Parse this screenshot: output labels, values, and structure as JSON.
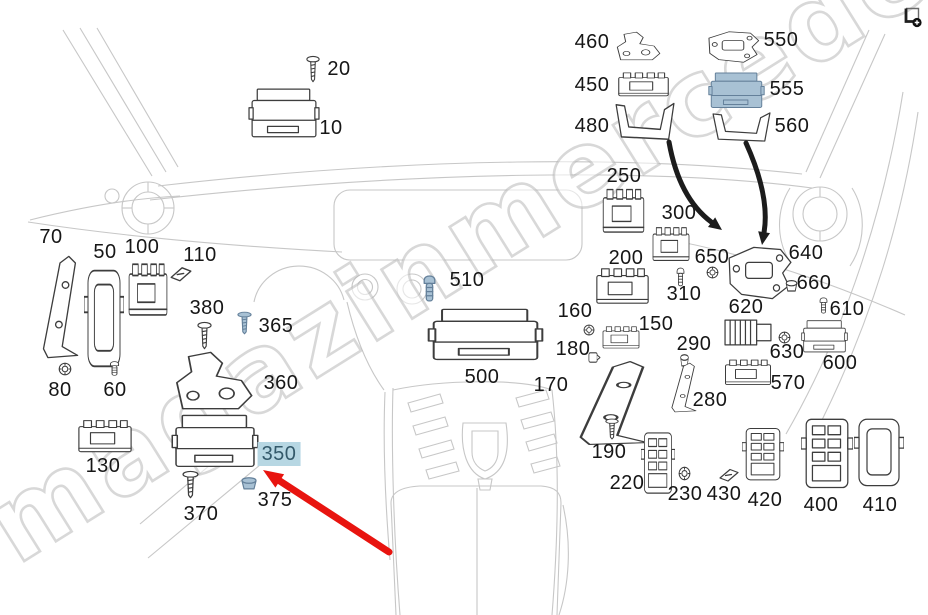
{
  "watermark": {
    "text": "magazinmercedes.ru"
  },
  "icons": {
    "top_right": "enlarge-image-icon"
  },
  "colors": {
    "highlight_bg": "#b7d7e3",
    "highlight_text": "#33596a",
    "red_arrow": "#e8140f",
    "black_arrow": "#1c1c1c",
    "blue_part_fill": "#a8c1d4",
    "line_art": "#3d3d3d",
    "sketch": "#c7c7c7"
  },
  "annotations": {
    "highlighted_part": "350",
    "red_arrow": {
      "from": [
        389,
        552
      ],
      "to": [
        263,
        470
      ]
    },
    "black_arrows": [
      {
        "from": [
          669,
          142
        ],
        "ctrl": [
          679,
          198
        ],
        "to": [
          722,
          230
        ]
      },
      {
        "from": [
          746,
          143
        ],
        "ctrl": [
          770,
          196
        ],
        "to": [
          762,
          245
        ]
      }
    ]
  },
  "diagram": {
    "parts": [
      {
        "label": "10",
        "kind": "ecu",
        "x": 248,
        "y": 85,
        "w": 72,
        "h": 58,
        "lx": 331,
        "ly": 128
      },
      {
        "label": "20",
        "kind": "screw",
        "x": 306,
        "y": 55,
        "w": 14,
        "h": 28,
        "lx": 339,
        "ly": 69
      },
      {
        "label": "460",
        "kind": "bracket",
        "x": 614,
        "y": 30,
        "w": 50,
        "h": 32,
        "lx": 592,
        "ly": 42
      },
      {
        "label": "550",
        "kind": "platebracket",
        "x": 704,
        "y": 28,
        "w": 58,
        "h": 38,
        "lx": 781,
        "ly": 40
      },
      {
        "label": "450",
        "kind": "module",
        "x": 616,
        "y": 71,
        "w": 55,
        "h": 28,
        "lx": 592,
        "ly": 85
      },
      {
        "label": "555",
        "kind": "ecu",
        "blue": true,
        "x": 708,
        "y": 70,
        "w": 57,
        "h": 42,
        "lx": 787,
        "ly": 89
      },
      {
        "label": "480",
        "kind": "ubracket",
        "x": 613,
        "y": 101,
        "w": 63,
        "h": 42,
        "lx": 592,
        "ly": 126
      },
      {
        "label": "560",
        "kind": "ubracket",
        "x": 710,
        "y": 111,
        "w": 62,
        "h": 33,
        "lx": 792,
        "ly": 126
      },
      {
        "label": "250",
        "kind": "module",
        "x": 601,
        "y": 186,
        "w": 45,
        "h": 52,
        "lx": 624,
        "ly": 176
      },
      {
        "label": "300",
        "kind": "module",
        "x": 651,
        "y": 225,
        "w": 40,
        "h": 40,
        "lx": 679,
        "ly": 213
      },
      {
        "label": "70",
        "kind": "brackettall",
        "x": 38,
        "y": 252,
        "w": 44,
        "h": 110,
        "lx": 51,
        "ly": 237
      },
      {
        "label": "50",
        "kind": "cover",
        "x": 84,
        "y": 266,
        "w": 40,
        "h": 108,
        "lx": 105,
        "ly": 252
      },
      {
        "label": "100",
        "kind": "module",
        "x": 127,
        "y": 260,
        "w": 42,
        "h": 62,
        "lx": 142,
        "ly": 247
      },
      {
        "label": "110",
        "kind": "fuse",
        "x": 169,
        "y": 265,
        "w": 24,
        "h": 18,
        "lx": 200,
        "ly": 255
      },
      {
        "label": "80",
        "kind": "nut",
        "x": 58,
        "y": 362,
        "w": 14,
        "h": 14,
        "lx": 60,
        "ly": 390
      },
      {
        "label": "60",
        "kind": "bolt",
        "x": 108,
        "y": 360,
        "w": 13,
        "h": 17,
        "lx": 115,
        "ly": 390
      },
      {
        "label": "650",
        "kind": "nut",
        "x": 706,
        "y": 266,
        "w": 13,
        "h": 13,
        "lx": 712,
        "ly": 257
      },
      {
        "label": "640",
        "kind": "platebracket",
        "x": 723,
        "y": 241,
        "w": 72,
        "h": 64,
        "lx": 806,
        "ly": 253
      },
      {
        "label": "200",
        "kind": "module",
        "x": 594,
        "y": 266,
        "w": 57,
        "h": 42,
        "lx": 626,
        "ly": 258
      },
      {
        "label": "660",
        "kind": "grommet",
        "x": 784,
        "y": 279,
        "w": 15,
        "h": 14,
        "lx": 814,
        "ly": 283
      },
      {
        "label": "310",
        "kind": "bolt",
        "x": 675,
        "y": 266,
        "w": 11,
        "h": 22,
        "lx": 684,
        "ly": 294
      },
      {
        "label": "510",
        "kind": "bolt",
        "blue": true,
        "x": 421,
        "y": 273,
        "w": 17,
        "h": 31,
        "lx": 467,
        "ly": 280
      },
      {
        "label": "380",
        "kind": "screw",
        "x": 197,
        "y": 321,
        "w": 15,
        "h": 29,
        "lx": 207,
        "ly": 308
      },
      {
        "label": "365",
        "kind": "screw",
        "blue": true,
        "x": 237,
        "y": 311,
        "w": 15,
        "h": 24,
        "lx": 276,
        "ly": 326
      },
      {
        "label": "160",
        "kind": "nut",
        "x": 583,
        "y": 324,
        "w": 12,
        "h": 12,
        "lx": 575,
        "ly": 311
      },
      {
        "label": "150",
        "kind": "module",
        "x": 601,
        "y": 325,
        "w": 40,
        "h": 26,
        "lx": 656,
        "ly": 324
      },
      {
        "label": "610",
        "kind": "bolt",
        "x": 818,
        "y": 296,
        "w": 11,
        "h": 19,
        "lx": 847,
        "ly": 309
      },
      {
        "label": "620",
        "kind": "heatsink",
        "x": 723,
        "y": 316,
        "w": 51,
        "h": 33,
        "lx": 746,
        "ly": 307
      },
      {
        "label": "290",
        "kind": "grommet",
        "x": 679,
        "y": 353,
        "w": 11,
        "h": 15,
        "lx": 694,
        "ly": 344
      },
      {
        "label": "630",
        "kind": "nut",
        "x": 778,
        "y": 331,
        "w": 13,
        "h": 13,
        "lx": 787,
        "ly": 352
      },
      {
        "label": "600",
        "kind": "ecu",
        "x": 801,
        "y": 318,
        "w": 47,
        "h": 38,
        "lx": 840,
        "ly": 363
      },
      {
        "label": "180",
        "kind": "clip",
        "x": 587,
        "y": 350,
        "w": 14,
        "h": 15,
        "lx": 573,
        "ly": 349
      },
      {
        "label": "360",
        "kind": "bracket",
        "x": 171,
        "y": 348,
        "w": 88,
        "h": 65,
        "lx": 281,
        "ly": 383
      },
      {
        "label": "500",
        "kind": "ecu",
        "x": 427,
        "y": 305,
        "w": 117,
        "h": 61,
        "lx": 482,
        "ly": 377
      },
      {
        "label": "170",
        "kind": "brackettall",
        "x": 570,
        "y": 358,
        "w": 86,
        "h": 90,
        "lx": 551,
        "ly": 385
      },
      {
        "label": "570",
        "kind": "module",
        "x": 723,
        "y": 358,
        "w": 50,
        "h": 30,
        "lx": 788,
        "ly": 383
      },
      {
        "label": "280",
        "kind": "brackettall",
        "x": 668,
        "y": 361,
        "w": 31,
        "h": 53,
        "lx": 710,
        "ly": 400
      },
      {
        "label": "130",
        "kind": "module",
        "x": 76,
        "y": 418,
        "w": 58,
        "h": 38,
        "lx": 103,
        "ly": 466
      },
      {
        "label": "350",
        "kind": "ecu",
        "hl": true,
        "x": 171,
        "y": 411,
        "w": 88,
        "h": 62,
        "lx": 279,
        "ly": 454
      },
      {
        "label": "190",
        "kind": "screw",
        "x": 605,
        "y": 418,
        "w": 14,
        "h": 22,
        "lx": 609,
        "ly": 452
      },
      {
        "label": "375",
        "kind": "grommet",
        "blue": true,
        "x": 239,
        "y": 476,
        "w": 20,
        "h": 15,
        "lx": 275,
        "ly": 500
      },
      {
        "label": "220",
        "kind": "fusebox",
        "x": 641,
        "y": 430,
        "w": 34,
        "h": 68,
        "lx": 627,
        "ly": 483
      },
      {
        "label": "370",
        "kind": "screw",
        "x": 182,
        "y": 470,
        "w": 17,
        "h": 29,
        "lx": 201,
        "ly": 514
      },
      {
        "label": "230",
        "kind": "nut",
        "x": 678,
        "y": 466,
        "w": 13,
        "h": 15,
        "lx": 685,
        "ly": 494
      },
      {
        "label": "430",
        "kind": "fuse",
        "x": 718,
        "y": 467,
        "w": 22,
        "h": 16,
        "lx": 724,
        "ly": 494
      },
      {
        "label": "420",
        "kind": "fusebox",
        "x": 742,
        "y": 426,
        "w": 42,
        "h": 58,
        "lx": 765,
        "ly": 500
      },
      {
        "label": "400",
        "kind": "fusebox",
        "x": 801,
        "y": 416,
        "w": 52,
        "h": 77,
        "lx": 821,
        "ly": 505
      },
      {
        "label": "410",
        "kind": "cover",
        "x": 854,
        "y": 416,
        "w": 50,
        "h": 75,
        "lx": 880,
        "ly": 505
      }
    ]
  }
}
